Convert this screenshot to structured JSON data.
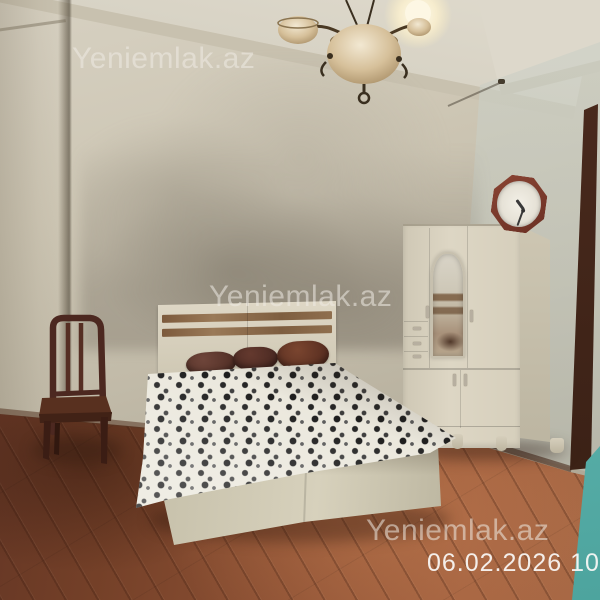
{
  "watermarks": {
    "top_left": "Yeniemlak.az",
    "center": "Yeniemlak.az",
    "bottom_right": "Yeniemlak.az"
  },
  "timestamp": "06.02.2026 10:32",
  "scene": {
    "type": "bedroom-listing-photo",
    "objects": [
      "chandelier-with-lit-bulb",
      "octagonal-wall-clock",
      "cream-wardrobe-with-arched-mirror",
      "double-bed-striped-headboard",
      "three-brown-pillows",
      "black-white-patterned-blanket",
      "dark-wooden-chair",
      "reddish-laminate-floor",
      "dark-door-frame",
      "teal-door-panel"
    ],
    "colors": {
      "wall_beige": "#c6bfad",
      "ceiling": "#dcd7c9",
      "floor_dark": "#5e3223",
      "floor_light": "#a96a46",
      "wardrobe_cream": "#d8d1bf",
      "headboard_stripe": "#8a684a",
      "pillow_brown": "#5a352b",
      "blanket_base": "#ebe8dd",
      "blanket_pattern": "#262626",
      "chair_wood": "#4c2820",
      "clock_frame": "#7c3b2b",
      "teal_accent": "#56b3ae",
      "watermark_text": "rgba(238,235,228,0.55)"
    }
  }
}
